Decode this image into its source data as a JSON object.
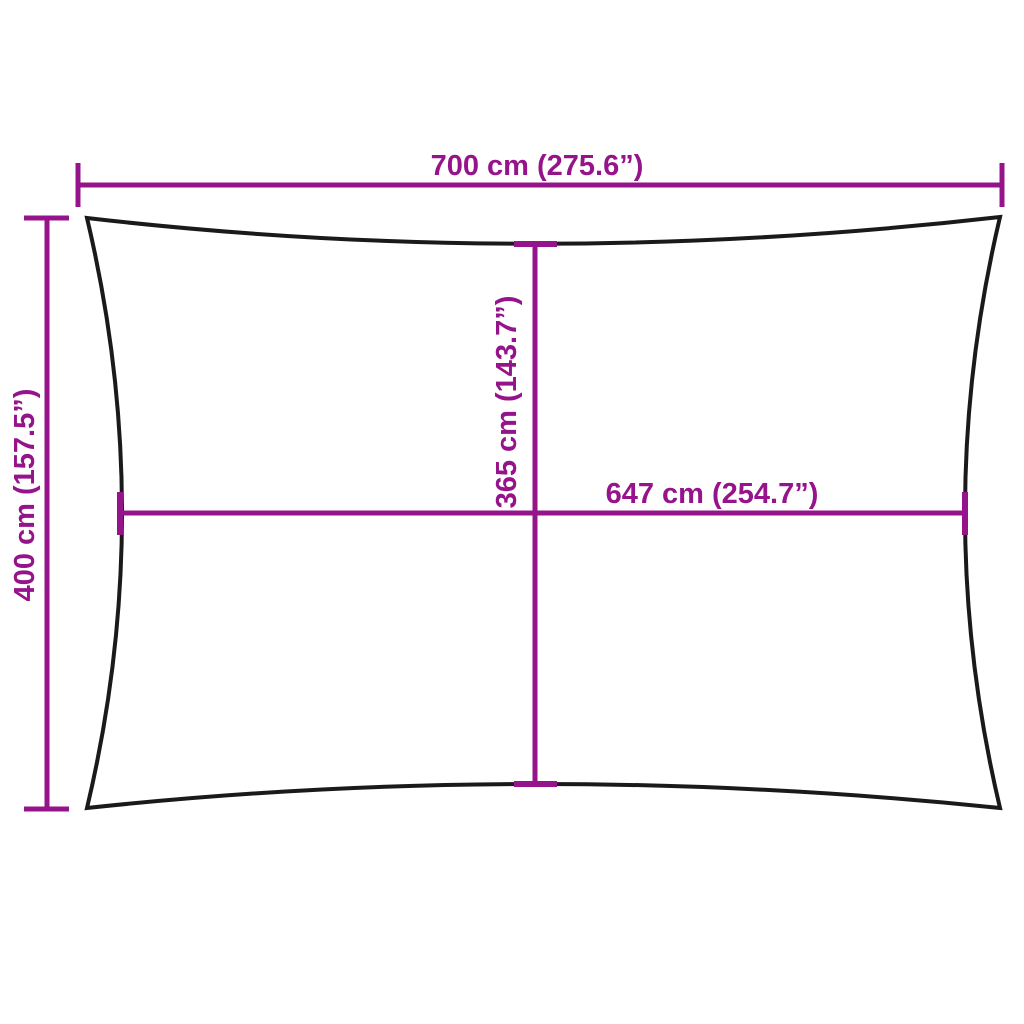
{
  "diagram": {
    "labels": {
      "width_top": "700 cm (275.6”)",
      "height_left": "400 cm (157.5”)",
      "inner_height": "365 cm (143.7”)",
      "inner_width": "647 cm (254.7”)"
    },
    "colors": {
      "dimension": "#96148B",
      "outline": "#1A1A1A",
      "background": "#FFFFFF"
    }
  }
}
